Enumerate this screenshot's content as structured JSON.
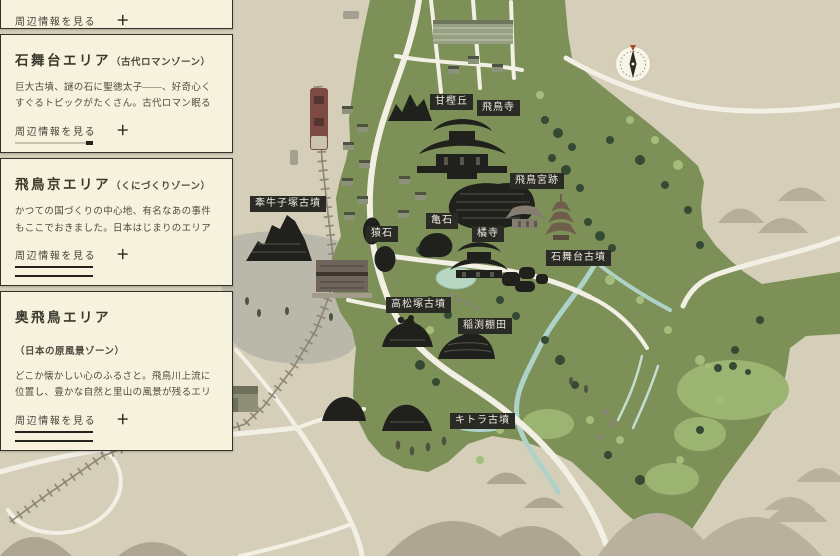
{
  "sidebar": {
    "more_label": "周辺情報を見る",
    "plus_symbol": "＋",
    "areas": [
      {
        "title": "石舞台エリア",
        "zone": "（古代ロマンゾーン）",
        "description": "巨大古墳、謎の石に聖徳太子――、好奇心くすぐるトピックがたくさん。古代ロマン眠るエリアです。"
      },
      {
        "title": "飛鳥京エリア",
        "zone": "（くにづくりゾーン）",
        "description": "かつての国づくりの中心地、有名なあの事件もここでおきました。日本はじまりのエリアです。"
      },
      {
        "title": "奥飛鳥エリア",
        "zone": "（日本の原風景ゾーン）",
        "description": "どこか懐かしい心のふるさと。飛鳥川上流に位置し、豊かな自然と里山の風景が残るエリアです。"
      }
    ]
  },
  "map": {
    "labels": [
      {
        "id": "amakashi-hill",
        "text": "甘樫丘"
      },
      {
        "id": "asukadera-temple",
        "text": "飛鳥寺"
      },
      {
        "id": "asuka-palace-site",
        "text": "飛鳥宮跡"
      },
      {
        "id": "kengoshizuka-tomb",
        "text": "牽牛子塚古墳"
      },
      {
        "id": "kameishi-stone",
        "text": "亀石"
      },
      {
        "id": "saruishi-stones",
        "text": "猿石"
      },
      {
        "id": "tachibanadera-temple",
        "text": "橘寺"
      },
      {
        "id": "ishibutai-tomb",
        "text": "石舞台古墳"
      },
      {
        "id": "takamatsuzuka-tomb",
        "text": "高松塚古墳"
      },
      {
        "id": "inabuchi-terraces",
        "text": "稲渕棚田"
      },
      {
        "id": "kitora-tomb",
        "text": "キトラ古墳"
      }
    ],
    "icons": {
      "compass": "compass-rose-icon"
    }
  },
  "colors": {
    "background_tan": "#d5cfba",
    "map_green": "#7c9057",
    "panel_cream": "#f6f2de",
    "label_chip_bg": "#2b2b26",
    "label_chip_text": "#edeadf",
    "road": "#f2efe4",
    "river": "#aed2c8",
    "railway": "#8d8574",
    "train": "#7d4b43",
    "landmark_black": "#20211d"
  }
}
